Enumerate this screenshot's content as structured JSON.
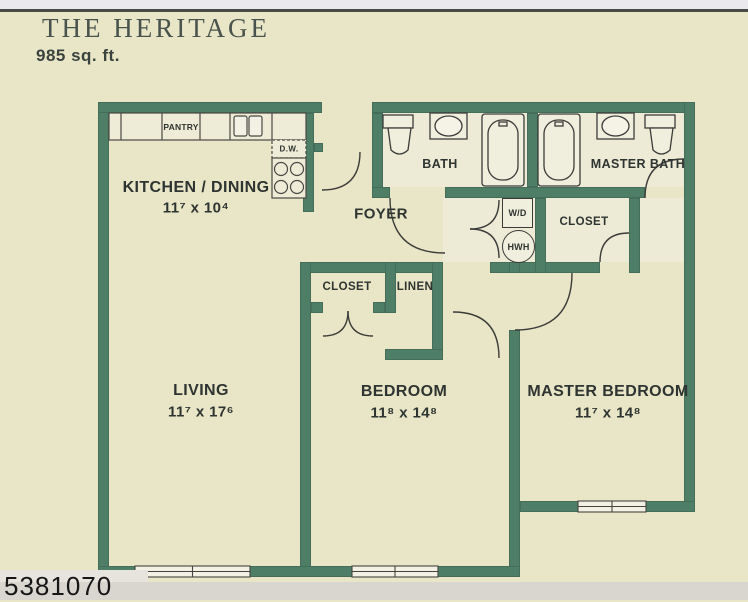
{
  "header": {
    "title": "THE HERITAGE",
    "area": "985 sq. ft."
  },
  "photo_id": "5381070",
  "rooms": {
    "kitchen": {
      "name": "KITCHEN / DINING",
      "dims": "11⁷ x 10⁴"
    },
    "living": {
      "name": "LIVING",
      "dims": "11⁷ x 17⁶"
    },
    "bedroom": {
      "name": "BEDROOM",
      "dims": "11⁸ x 14⁸"
    },
    "master_bedroom": {
      "name": "MASTER BEDROOM",
      "dims": "11⁷ x 14⁸"
    },
    "bath": {
      "name": "BATH"
    },
    "master_bath": {
      "name": "MASTER BATH"
    },
    "foyer": {
      "name": "FOYER"
    },
    "closet_master": {
      "name": "CLOSET"
    },
    "closet_bedroom": {
      "name": "CLOSET"
    },
    "linen": {
      "name": "LINEN"
    },
    "pantry": {
      "name": "PANTRY"
    }
  },
  "fixtures": {
    "washer_dryer": "W/D",
    "water_heater": "HWH",
    "dishwasher": "D.W."
  },
  "colors": {
    "wall": "#4f7e67",
    "paper": "#e8e6c6",
    "line": "#3c3c3a"
  }
}
